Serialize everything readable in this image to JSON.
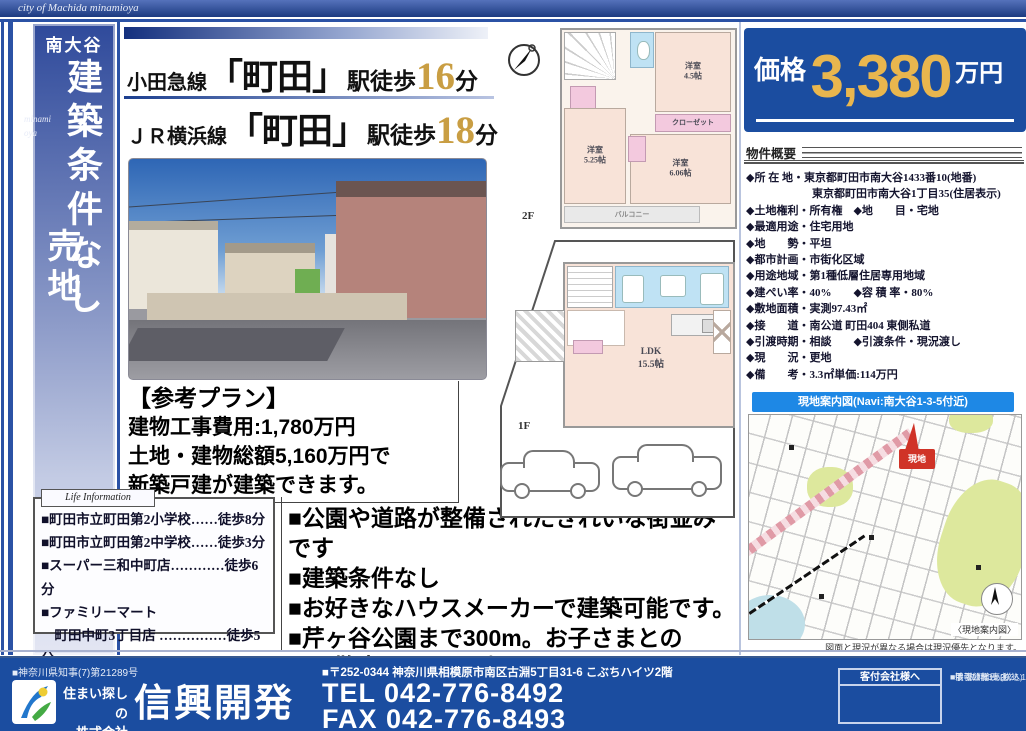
{
  "colors": {
    "accent_blue": "#1b4da0",
    "gold": "#e9b64e",
    "map_header_blue": "#1e88e5",
    "marker_red": "#d03327"
  },
  "top_banner": {
    "title": "city of Machida minamioya"
  },
  "sidebar": {
    "area": "南大谷",
    "catch_vertical": "建築条件なし",
    "type_vertical": "売地",
    "romaji_line1": "minami",
    "romaji_line2": "oya"
  },
  "access": {
    "line1": {
      "rail": "小田急線",
      "station": "「町田」",
      "walk": "駅徒歩",
      "min": "16",
      "unit": "分"
    },
    "line2": {
      "rail": "ＪＲ横浜線",
      "station": "「町田」",
      "walk": "駅徒歩",
      "min": "18",
      "unit": "分"
    }
  },
  "price": {
    "label": "価格",
    "value": "3,380",
    "unit": "万円"
  },
  "outline": {
    "header": "物件概要",
    "items": [
      "◆所 在 地・東京都町田市南大谷1433番10(地番)",
      "　　　　　　東京都町田市南大谷1丁目35(住居表示)",
      "◆土地権利・所有権　◆地　　目・宅地",
      "◆最適用途・住宅用地",
      "◆地　　勢・平坦",
      "◆都市計画・市街化区域",
      "◆用途地域・第1種低層住居専用地域",
      "◆建ぺい率・40%　　◆容 積 率・80%",
      "◆敷地面積・実測97.43㎡",
      "◆接　　道・南公道 町田404 東側私道",
      "◆引渡時期・相談　　◆引渡条件・現況渡し",
      "◆現　　況・更地",
      "◆備　　考・3.3㎡単価:114万円"
    ]
  },
  "plan_note": {
    "title": "【参考プラン】",
    "line1": "建物工事費用:1,780万円",
    "line2": "土地・建物総額5,160万円で",
    "line3": "新築戸建が建築できます。"
  },
  "life_info": {
    "label": "Life Information",
    "items": [
      "■町田市立町田第2小学校……徒歩8分",
      "■町田市立町田第2中学校……徒歩3分",
      "■スーパー三和中町店…………徒歩6分",
      "■ファミリーマート",
      "　町田中町3丁目店 ……………徒歩5分"
    ]
  },
  "features": [
    "■公園や道路が整備されたきれいな街並みです",
    "■建築条件なし",
    "■お好きなハウスメーカーで建築可能です。",
    "■芹ヶ谷公園まで300m。お子さまとの",
    "　お散歩コースにぴったりです"
  ],
  "floorplan": {
    "f2": {
      "label": "2F",
      "room1_name": "洋室",
      "room1_size": "4.5帖",
      "room2_name": "洋室",
      "room2_size": "5.25帖",
      "room3_name": "洋室",
      "room3_size": "6.06帖",
      "closet": "クローゼット",
      "balcony": "バルコニー"
    },
    "f1": {
      "label": "1F",
      "ldk_name": "LDK",
      "ldk_size": "15.5帖"
    }
  },
  "map": {
    "header": "現地案内図(Navi:南大谷1-3-5付近)",
    "marker": "現地",
    "corner_label": "〈現地案内図〉",
    "caption": "図面と現況が異なる場合は現況優先となります。"
  },
  "footer": {
    "license": "■神奈川県知事(7)第21289号",
    "tagline1": "住まい探しの",
    "tagline2": "株式会社",
    "company": "信興開発",
    "address": "■〒252-0344 神奈川県相模原市南区古淵5丁目31-6 こぶちハイツ2階",
    "tel": "TEL 042-776-8492",
    "fax": "FAX 042-776-8493",
    "agent_box_title": "客付会社様へ",
    "note1": "■手 数 料:3%(税込)",
    "note2": "■取引態様:売主",
    "note3": "■情報公開日:2025.12.22"
  }
}
